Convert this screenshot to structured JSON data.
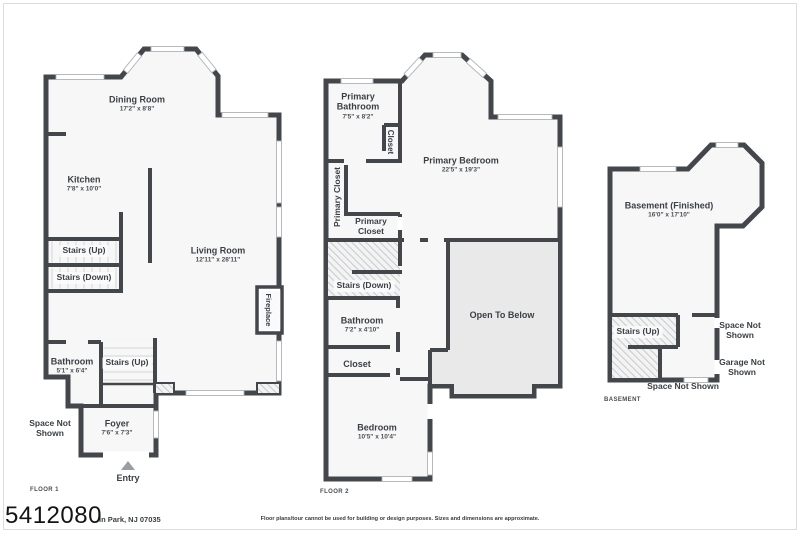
{
  "page": {
    "watermark": "5412080",
    "address_fragment": "ln Park, NJ 07035",
    "disclaimer": "Floor plans/tour cannot be used for building or design purposes. Sizes and dimensions are approximate."
  },
  "colors": {
    "wall": "#43464a",
    "room_fill": "#f7f7f8",
    "open_to_below_fill": "#e9e9ea",
    "hatch_line": "#c7c9cb",
    "tread_line": "#d9dadb"
  },
  "floor1": {
    "caption": "FLOOR 1",
    "dining_room": {
      "name": "Dining Room",
      "dims": "17'2\" x 8'8\""
    },
    "kitchen": {
      "name": "Kitchen",
      "dims": "7'8\" x 10'0\""
    },
    "living_room": {
      "name": "Living Room",
      "dims": "12'11\" x 28'11\""
    },
    "stairs_up_main": {
      "name": "Stairs (Up)"
    },
    "stairs_down": {
      "name": "Stairs (Down)"
    },
    "bathroom": {
      "name": "Bathroom",
      "dims": "5'1\" x 6'4\""
    },
    "stairs_up_entry": {
      "name": "Stairs (Up)"
    },
    "foyer": {
      "name": "Foyer",
      "dims": "7'6\" x 7'3\""
    },
    "space_not_shown": {
      "name": "Space Not Shown"
    },
    "fireplace": {
      "name": "Fireplace"
    },
    "entry": {
      "name": "Entry"
    }
  },
  "floor2": {
    "caption": "FLOOR 2",
    "primary_bathroom": {
      "name": "Primary Bathroom",
      "dims": "7'5\" x 8'2\""
    },
    "closet_small": {
      "name": "Closet"
    },
    "primary_closet_corridor": {
      "name": "Primary Closet"
    },
    "primary_closet_room": {
      "name": "Primary Closet"
    },
    "primary_bedroom": {
      "name": "Primary Bedroom",
      "dims": "22'5\" x 19'3\""
    },
    "stairs_down": {
      "name": "Stairs (Down)"
    },
    "bathroom": {
      "name": "Bathroom",
      "dims": "7'2\" x 4'10\""
    },
    "closet": {
      "name": "Closet"
    },
    "bedroom": {
      "name": "Bedroom",
      "dims": "10'5\" x 10'4\""
    },
    "open_to_below": {
      "name": "Open To Below"
    }
  },
  "basement": {
    "caption": "BASEMENT",
    "finished": {
      "name": "Basement (Finished)",
      "dims": "16'0\" x 17'10\""
    },
    "stairs_up": {
      "name": "Stairs (Up)"
    },
    "space_not_shown_right": {
      "name": "Space Not Shown"
    },
    "garage_not_shown": {
      "name": "Garage Not Shown"
    },
    "space_not_shown_bottom": {
      "name": "Space Not Shown"
    }
  }
}
